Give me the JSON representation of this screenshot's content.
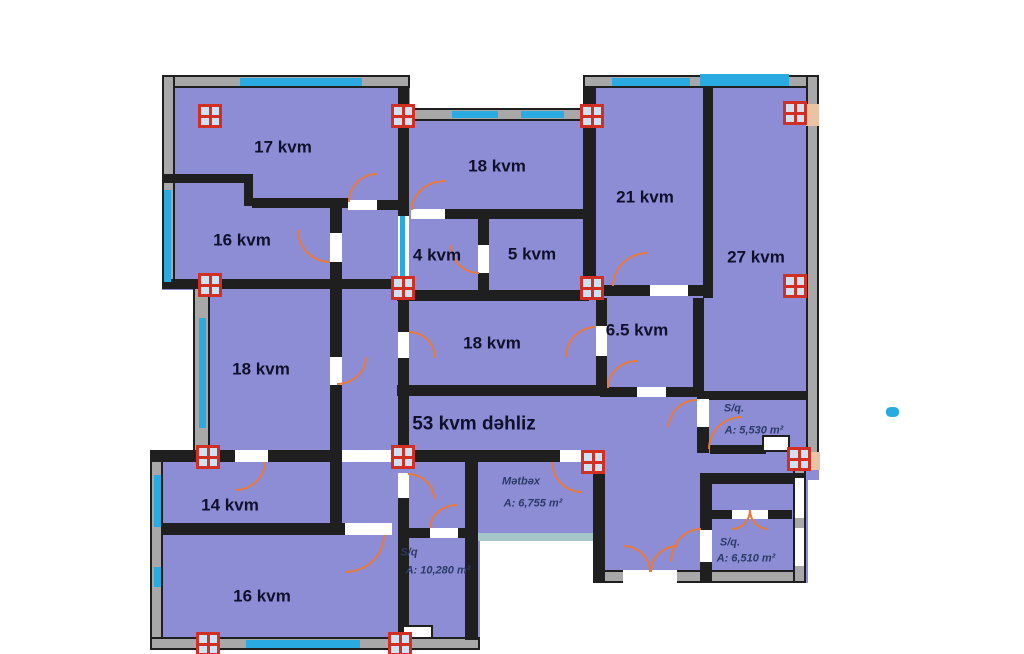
{
  "plan": {
    "unit_note": "kvm",
    "colors": {
      "room_fill": "#8d8dd6",
      "wall_dark": "#1f1f1f",
      "wall_outer": "#a8a8a8",
      "window_blue": "#29abe2",
      "door_orange": "#e8793c",
      "column_border": "#d03024",
      "column_fill": "#cfe2f4"
    },
    "rooms": [
      {
        "label": "17 kvm"
      },
      {
        "label": "16 kvm"
      },
      {
        "label": "18 kvm"
      },
      {
        "label": "21 kvm"
      },
      {
        "label": "27 kvm"
      },
      {
        "label": "4 kvm"
      },
      {
        "label": "5 kvm"
      },
      {
        "label": "6.5 kvm"
      },
      {
        "label": "18 kvm"
      },
      {
        "label": "18 kvm"
      },
      {
        "label": "53 kvm dəhliz"
      },
      {
        "label": "14 kvm"
      },
      {
        "label": "16 kvm"
      },
      {
        "label": "Mətbəx",
        "area": "A: 6,755 m²"
      },
      {
        "label": "S/q.",
        "area": "A: 5,530 m²"
      },
      {
        "label": "S/q.",
        "area": "A: 6,510 m²"
      },
      {
        "label": "S/q",
        "area": "A: 10,280 m²"
      }
    ]
  }
}
